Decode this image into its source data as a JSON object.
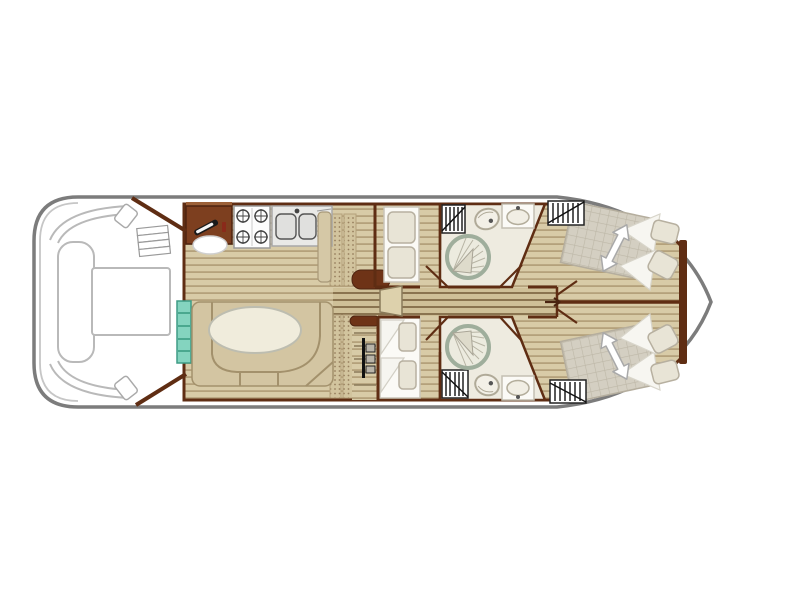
{
  "image": {
    "kind": "boat-floor-plan",
    "width": 800,
    "height": 601,
    "orientation": "bow-right"
  },
  "colors": {
    "background": "#ffffff",
    "hull_outline": "#7c7c7c",
    "inner_deck_line": "#c6c6c6",
    "wall_brown": "#5f2d13",
    "cabinet_brown": "#7d3f1f",
    "cabinet_brown_dark": "#4e2410",
    "floor_plank_base": "#d8cba7",
    "floor_plank_line": "#b4a17b",
    "corridor_plank_line": "#8a7450",
    "bathroom_floor": "#eeebe0",
    "stairs_teal": "#84d4bf",
    "stairs_teal_dark": "#4aa88f",
    "bench_tan": "#d3c5a2",
    "bench_line": "#a3916c",
    "table_cream": "#f0ecdc",
    "bed_white": "#fbfaf6",
    "pillow_beige": "#e8e4d6",
    "mattress_grey": "#d4cfc2",
    "shower_rim": "#9fae9c"
  },
  "rooms": [
    {
      "name": "aft-deck",
      "items": [
        "curved-bench",
        "side-bench",
        "deck-table",
        "helm-seat-port",
        "helm-seat-starboard",
        "boarding-steps"
      ]
    },
    {
      "name": "galley",
      "items": [
        "refrigerator-counter",
        "chopping-knife",
        "gas-hob",
        "double-sink-with-drainer",
        "counter-end"
      ]
    },
    {
      "name": "salon",
      "items": [
        "u-shaped-bench",
        "oval-table",
        "storage-backrest",
        "shelf-cabinet"
      ]
    },
    {
      "name": "companionway",
      "items": [
        "teal-stairs",
        "entry-arch"
      ]
    },
    {
      "name": "corridor",
      "items": [
        "sliding-door",
        "passage-arrow"
      ]
    },
    {
      "name": "mid-cabin-port",
      "items": [
        "twin-berths",
        "pillows",
        "wardrobe"
      ]
    },
    {
      "name": "mid-bathroom-port",
      "items": [
        "circular-shower",
        "toilet",
        "washbasin",
        "door"
      ]
    },
    {
      "name": "mid-cabin-starboard",
      "items": [
        "twin-berths",
        "blankets",
        "pillows",
        "wardrobe"
      ]
    },
    {
      "name": "mid-bathroom-starboard",
      "items": [
        "circular-shower",
        "toilet",
        "washbasin",
        "door"
      ]
    },
    {
      "name": "bow-cabin-port",
      "items": [
        "sliding-double-bed",
        "slide-arrow",
        "blankets",
        "pillows",
        "wardrobe",
        "door"
      ]
    },
    {
      "name": "bow-cabin-starboard",
      "items": [
        "sliding-double-bed",
        "slide-arrow",
        "blankets",
        "pillows",
        "wardrobe",
        "door"
      ]
    }
  ]
}
